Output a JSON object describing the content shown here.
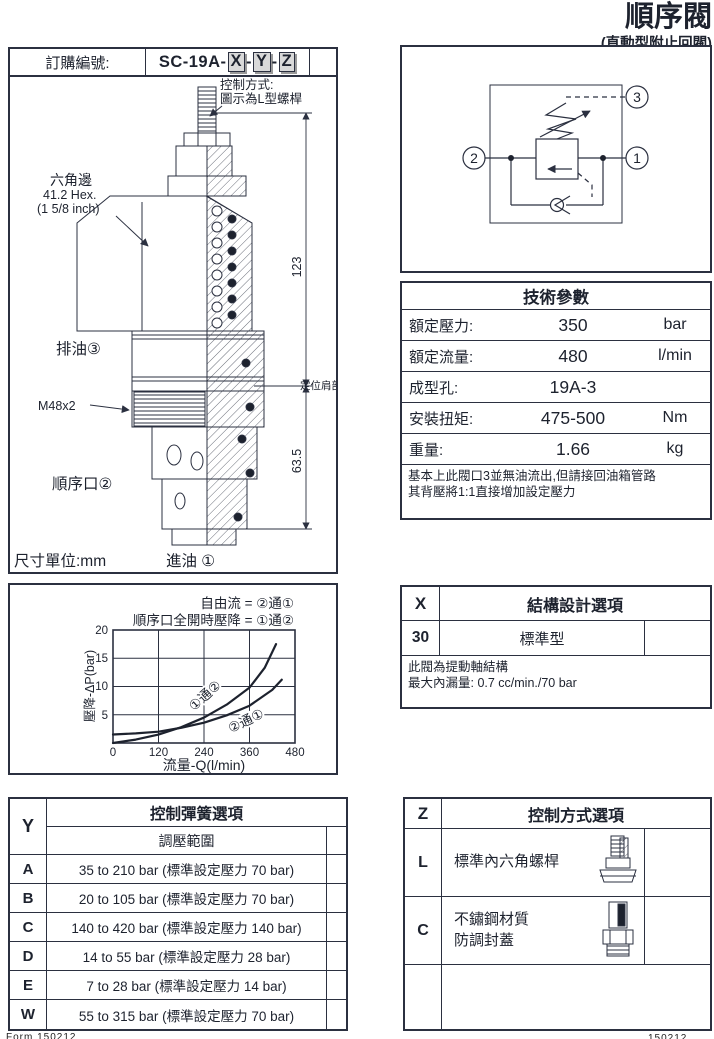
{
  "page": {
    "title": "順序閥",
    "subtitle": "(直動型附止回閥)"
  },
  "colors": {
    "ink": "#1d222e",
    "line": "#2b3040",
    "code_box_bg": "#d9d9d9"
  },
  "order": {
    "label": "訂購編號:",
    "code_prefix": "SC-19A-",
    "code_x": "X",
    "sep1": "-",
    "code_y": "Y",
    "sep2": "-",
    "code_z": "Z"
  },
  "drawing": {
    "control_note_line1": "控制方式:",
    "control_note_line2": "圖示為L型螺桿",
    "hex_label_line1": "六角邊",
    "hex_label_line2": "41.2 Hex.",
    "hex_label_line3": "(1 5/8 inch)",
    "port3_label": "排油③",
    "thread_label": "M48x2",
    "port2_label": "順序口②",
    "port1_label": "進油 ①",
    "dim_total": "123",
    "dim_lower": "63.5",
    "shoulder_label": "定位肩部",
    "unit_label": "尺寸單位:mm"
  },
  "schematic": {
    "port1": "1",
    "port2": "2",
    "port3": "3"
  },
  "tech_table": {
    "title": "技術參數",
    "rows": [
      {
        "label": "額定壓力:",
        "value": "350",
        "unit": "bar"
      },
      {
        "label": "額定流量:",
        "value": "480",
        "unit": "l/min"
      },
      {
        "label": "成型孔:",
        "value": "19A-3",
        "unit": ""
      },
      {
        "label": "安裝扭矩:",
        "value": "475-500",
        "unit": "Nm"
      },
      {
        "label": "重量:",
        "value": "1.66",
        "unit": "kg"
      }
    ],
    "note_line1": "基本上此閥口3並無油流出,但請接回油箱管路",
    "note_line2": "其背壓將1:1直接增加設定壓力"
  },
  "chart_data": {
    "type": "line",
    "title_line1": "自由流 = ②通①",
    "title_line2": "順序口全開時壓降 = ①通②",
    "xlabel": "流量-Q(l/min)",
    "ylabel": "壓降-ΔP(bar)",
    "xlim": [
      0,
      480
    ],
    "ylim": [
      0,
      20
    ],
    "grid": true,
    "x_ticks": [
      "0",
      "120",
      "240",
      "360",
      "480"
    ],
    "y_ticks_top_down": [
      "20",
      "15",
      "10",
      "5"
    ],
    "series": [
      {
        "name": "①通②",
        "x": [
          0,
          60,
          120,
          180,
          240,
          300,
          360,
          400,
          430
        ],
        "y": [
          0,
          0.6,
          1.5,
          2.8,
          4.5,
          6.8,
          9.8,
          13.3,
          17.5
        ]
      },
      {
        "name": "②通①",
        "x": [
          0,
          60,
          120,
          180,
          240,
          300,
          360,
          420,
          445
        ],
        "y": [
          1.5,
          1.7,
          2.0,
          2.7,
          3.6,
          4.9,
          6.6,
          9.4,
          11.2
        ]
      }
    ]
  },
  "x_table": {
    "key": "X",
    "title": "結構設計選項",
    "rows": [
      {
        "code": "30",
        "desc": "標準型"
      }
    ],
    "note_line1": "此閥為提動軸結構",
    "note_line2": "最大內漏量: 0.7 cc/min./70 bar"
  },
  "y_table": {
    "key": "Y",
    "title": "控制彈簧選項",
    "subtitle": "調壓範圍",
    "rows": [
      {
        "code": "A",
        "desc": "35 to 210 bar (標準設定壓力 70 bar)"
      },
      {
        "code": "B",
        "desc": "20 to 105 bar (標準設定壓力 70 bar)"
      },
      {
        "code": "C",
        "desc": "140 to 420 bar (標準設定壓力 140 bar)"
      },
      {
        "code": "D",
        "desc": "14 to 55 bar (標準設定壓力 28 bar)"
      },
      {
        "code": "E",
        "desc": "7 to 28 bar (標準設定壓力 14 bar)"
      },
      {
        "code": "W",
        "desc": "55 to 315 bar (標準設定壓力 70 bar)"
      }
    ]
  },
  "z_table": {
    "key": "Z",
    "title": "控制方式選項",
    "rows": [
      {
        "code": "L",
        "desc_line1": "標準內六角螺桿",
        "desc_line2": ""
      },
      {
        "code": "C",
        "desc_line1": "不鏽鋼材質",
        "desc_line2": "防調封蓋"
      }
    ]
  },
  "footer": {
    "left_code": "Form 150212",
    "right_code": "150212"
  }
}
